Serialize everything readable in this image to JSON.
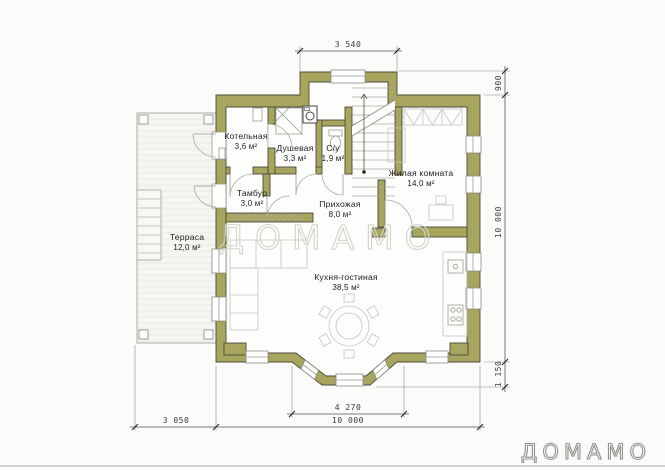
{
  "page": {
    "watermark": "ДОМАМО",
    "logo": "ДОМАМО"
  },
  "rooms": {
    "boiler": {
      "name": "Котельная",
      "area": "3,6 м²"
    },
    "shower": {
      "name": "Душевая",
      "area": "3,3 м²"
    },
    "wc": {
      "name": "С/у",
      "area": "1,9 м²"
    },
    "living": {
      "name": "Жилая комната",
      "area": "14,0 м²"
    },
    "tambour": {
      "name": "Тамбур",
      "area": "3,0 м²"
    },
    "hall": {
      "name": "Прихожая",
      "area": "8,0 м²"
    },
    "terrace": {
      "name": "Терраса",
      "area": "12,0 м²"
    },
    "kitchen": {
      "name": "Кухня-гостиная",
      "area": "38,5 м²"
    }
  },
  "dimensions": {
    "top_width": "3 540",
    "right_top": "900",
    "right_height": "10 000",
    "right_bottom": "1 150",
    "bay_width": "4 270",
    "bottom_left": "3 050",
    "bottom_width": "10 000"
  },
  "colors": {
    "wall": "#a7a55e",
    "wall_outline": "#4c4c3a"
  }
}
